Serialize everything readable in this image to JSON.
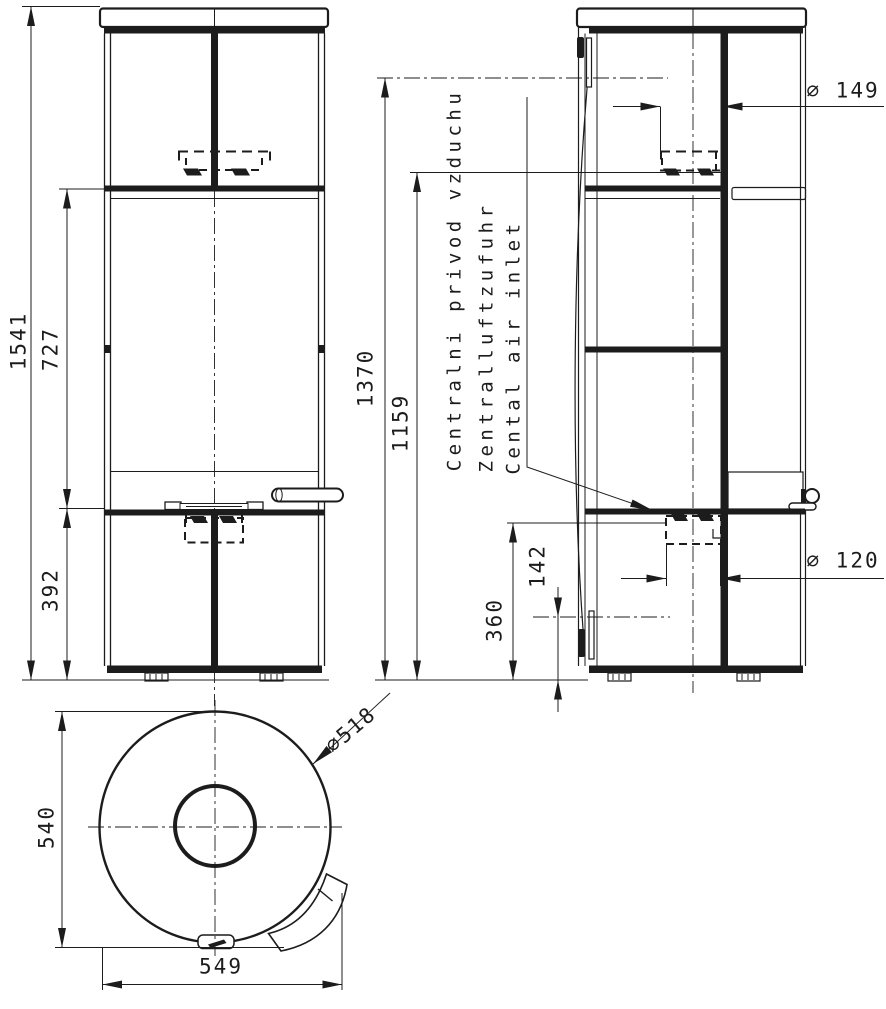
{
  "drawing_type": "technical dimensional drawing - stove",
  "views": {
    "front": {
      "name": "front-view",
      "dims": {
        "overall_height": "1541",
        "upper_section_height": "727",
        "lower_section_height": "392"
      }
    },
    "side": {
      "name": "side-view",
      "dims": {
        "rear_outlet_axis_height": "1370",
        "flue_collar_height": "1159",
        "flue_diameter": "⌀ 149",
        "air_inlet_diameter": "⌀ 120",
        "air_inlet_top_height": "360",
        "air_inlet_axis_height": "142"
      }
    },
    "top": {
      "name": "top-view",
      "dims": {
        "depth": "540",
        "overall_width": "549",
        "body_diameter": "⌀518"
      }
    }
  },
  "notes": {
    "air_inlet_label": {
      "cs": "Centralni privod vzduchu",
      "de": "Zentralluftzufuhr",
      "en": "Cental air inlet"
    }
  },
  "colors": {
    "line": "#1c1c1c",
    "background": "#ffffff"
  }
}
